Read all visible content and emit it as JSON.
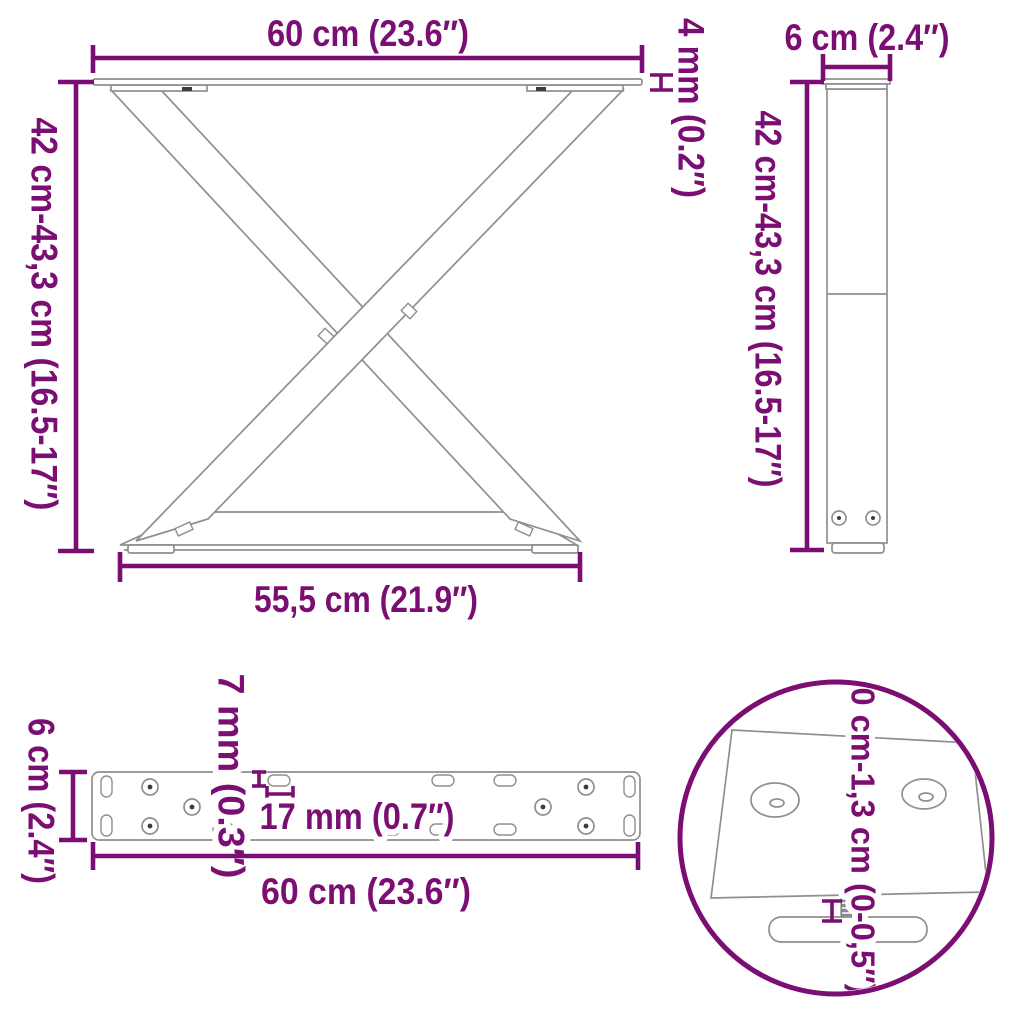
{
  "colors": {
    "accent": "#7B0E72",
    "line": "#8F8F8F",
    "dark": "#3C3C3C"
  },
  "views": {
    "front": {
      "width_top": "60 cm (23.6″)",
      "height_range": "42 cm-43,3 cm (16.5-17″)",
      "plate_thickness": "4 mm (0.2″)",
      "width_bottom": "55,5 cm (21.9″)"
    },
    "side": {
      "width": "6 cm (2.4″)",
      "height_range": "42 cm-43,3 cm (16.5-17″)"
    },
    "plate": {
      "depth": "6 cm (2.4″)",
      "slot_width": "7 mm (0.3″)",
      "slot_length": "17 mm (0.7″)",
      "width": "60 cm (23.6″)"
    },
    "detail": {
      "adjustable_range": "0 cm-1,3 cm (0-0,5″)"
    }
  }
}
